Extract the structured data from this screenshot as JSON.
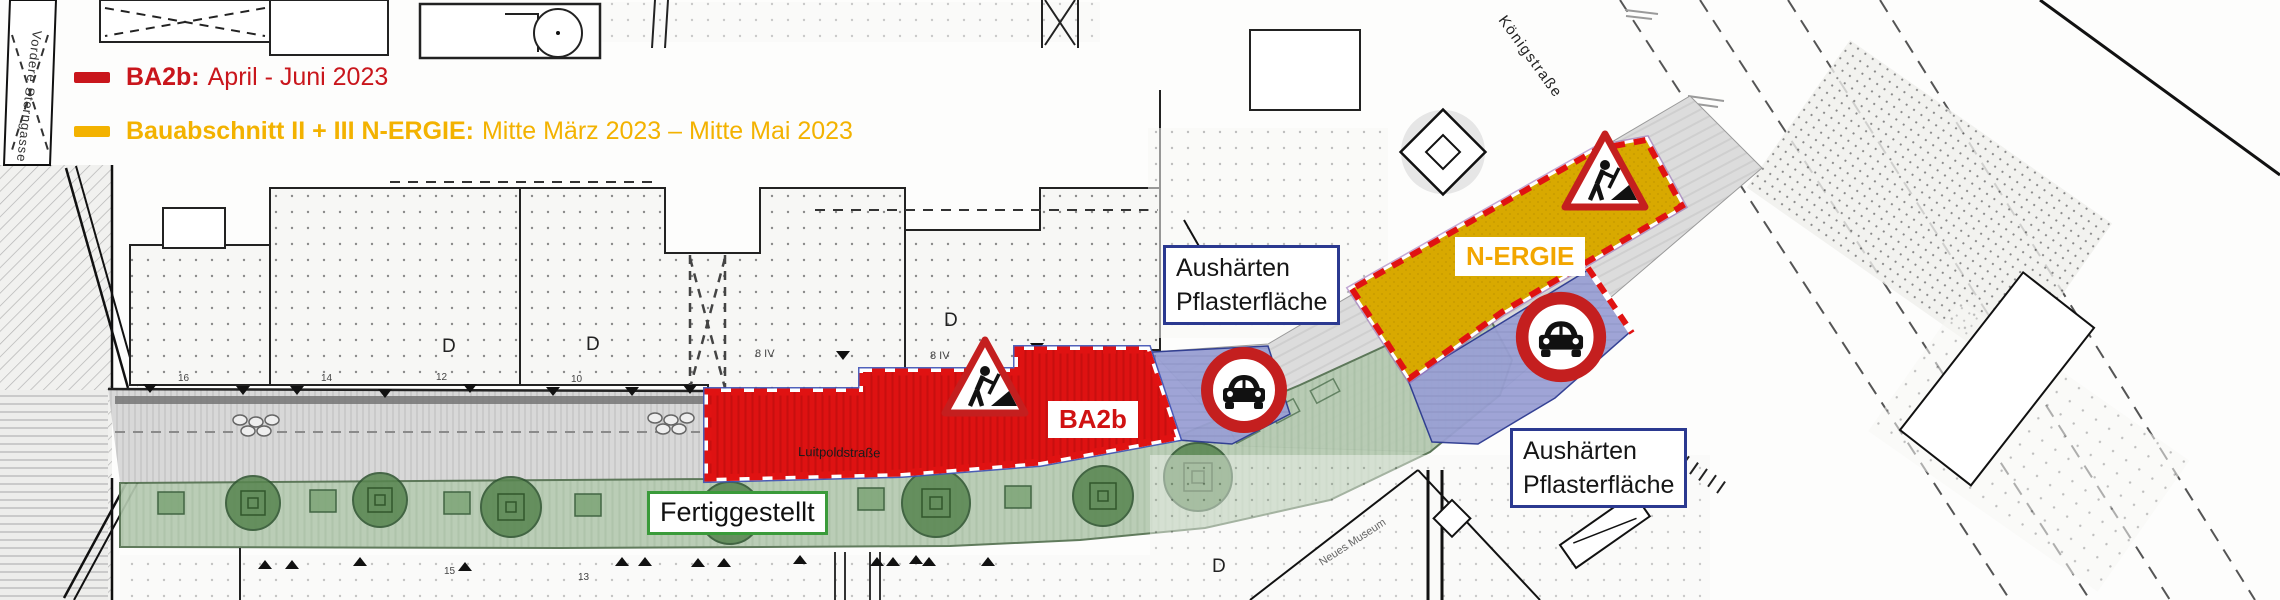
{
  "legend": {
    "items": [
      {
        "bold": "BA2b:",
        "rest": "April - Juni 2023",
        "color": "#c9161c"
      },
      {
        "bold": "Bauabschnitt II + III N-ERGIE:",
        "rest": "Mitte März 2023 – Mitte Mai 2023",
        "color": "#f3b200"
      }
    ]
  },
  "zones": {
    "ba2b": {
      "label": "BA2b",
      "color": "#de1212"
    },
    "completed": {
      "label": "Fertiggestellt",
      "color": "#b5cab1"
    },
    "nergie": {
      "label": "N-ERGIE",
      "color": "#d8a900"
    },
    "curing1": {
      "line1": "Aushärten",
      "line2": "Pflasterfläche",
      "color": "#9aa0d4"
    },
    "curing2": {
      "line1": "Aushärten",
      "line2": "Pflasterfläche",
      "color": "#9aa0d4"
    }
  },
  "streets": {
    "vordere_sterngasse": "Vordere Sterngasse",
    "koenigstrasse": "Königstraße",
    "luitpoldstrasse": "Luitpoldstraße",
    "neues_museum": "Neues Museum"
  },
  "map_annotations": {
    "d1": "D",
    "d2": "D",
    "d3": "D",
    "d4": "D",
    "floors1": "8 IV",
    "floors2": "8 IV",
    "house_numbers": {
      "n16": "16",
      "n14": "14",
      "n12": "12",
      "n10": "10",
      "n15": "15",
      "n13": "13"
    }
  },
  "icons": {
    "roadworks_sign": "roadworks-warning-triangle",
    "no_cars_sign": "no-motor-vehicles-prohibition-circle"
  },
  "colors": {
    "ba2b_red": "#de1212",
    "nergie_yellow": "#d8a900",
    "completed_green": "#b5cab1",
    "curing_blue": "#9aa0d4",
    "closure_border_red": "#e01212",
    "label_border_blue": "#2b3990",
    "label_border_green": "#3a9b3a",
    "legend_red": "#c9161c",
    "legend_yellow": "#f3b200"
  }
}
